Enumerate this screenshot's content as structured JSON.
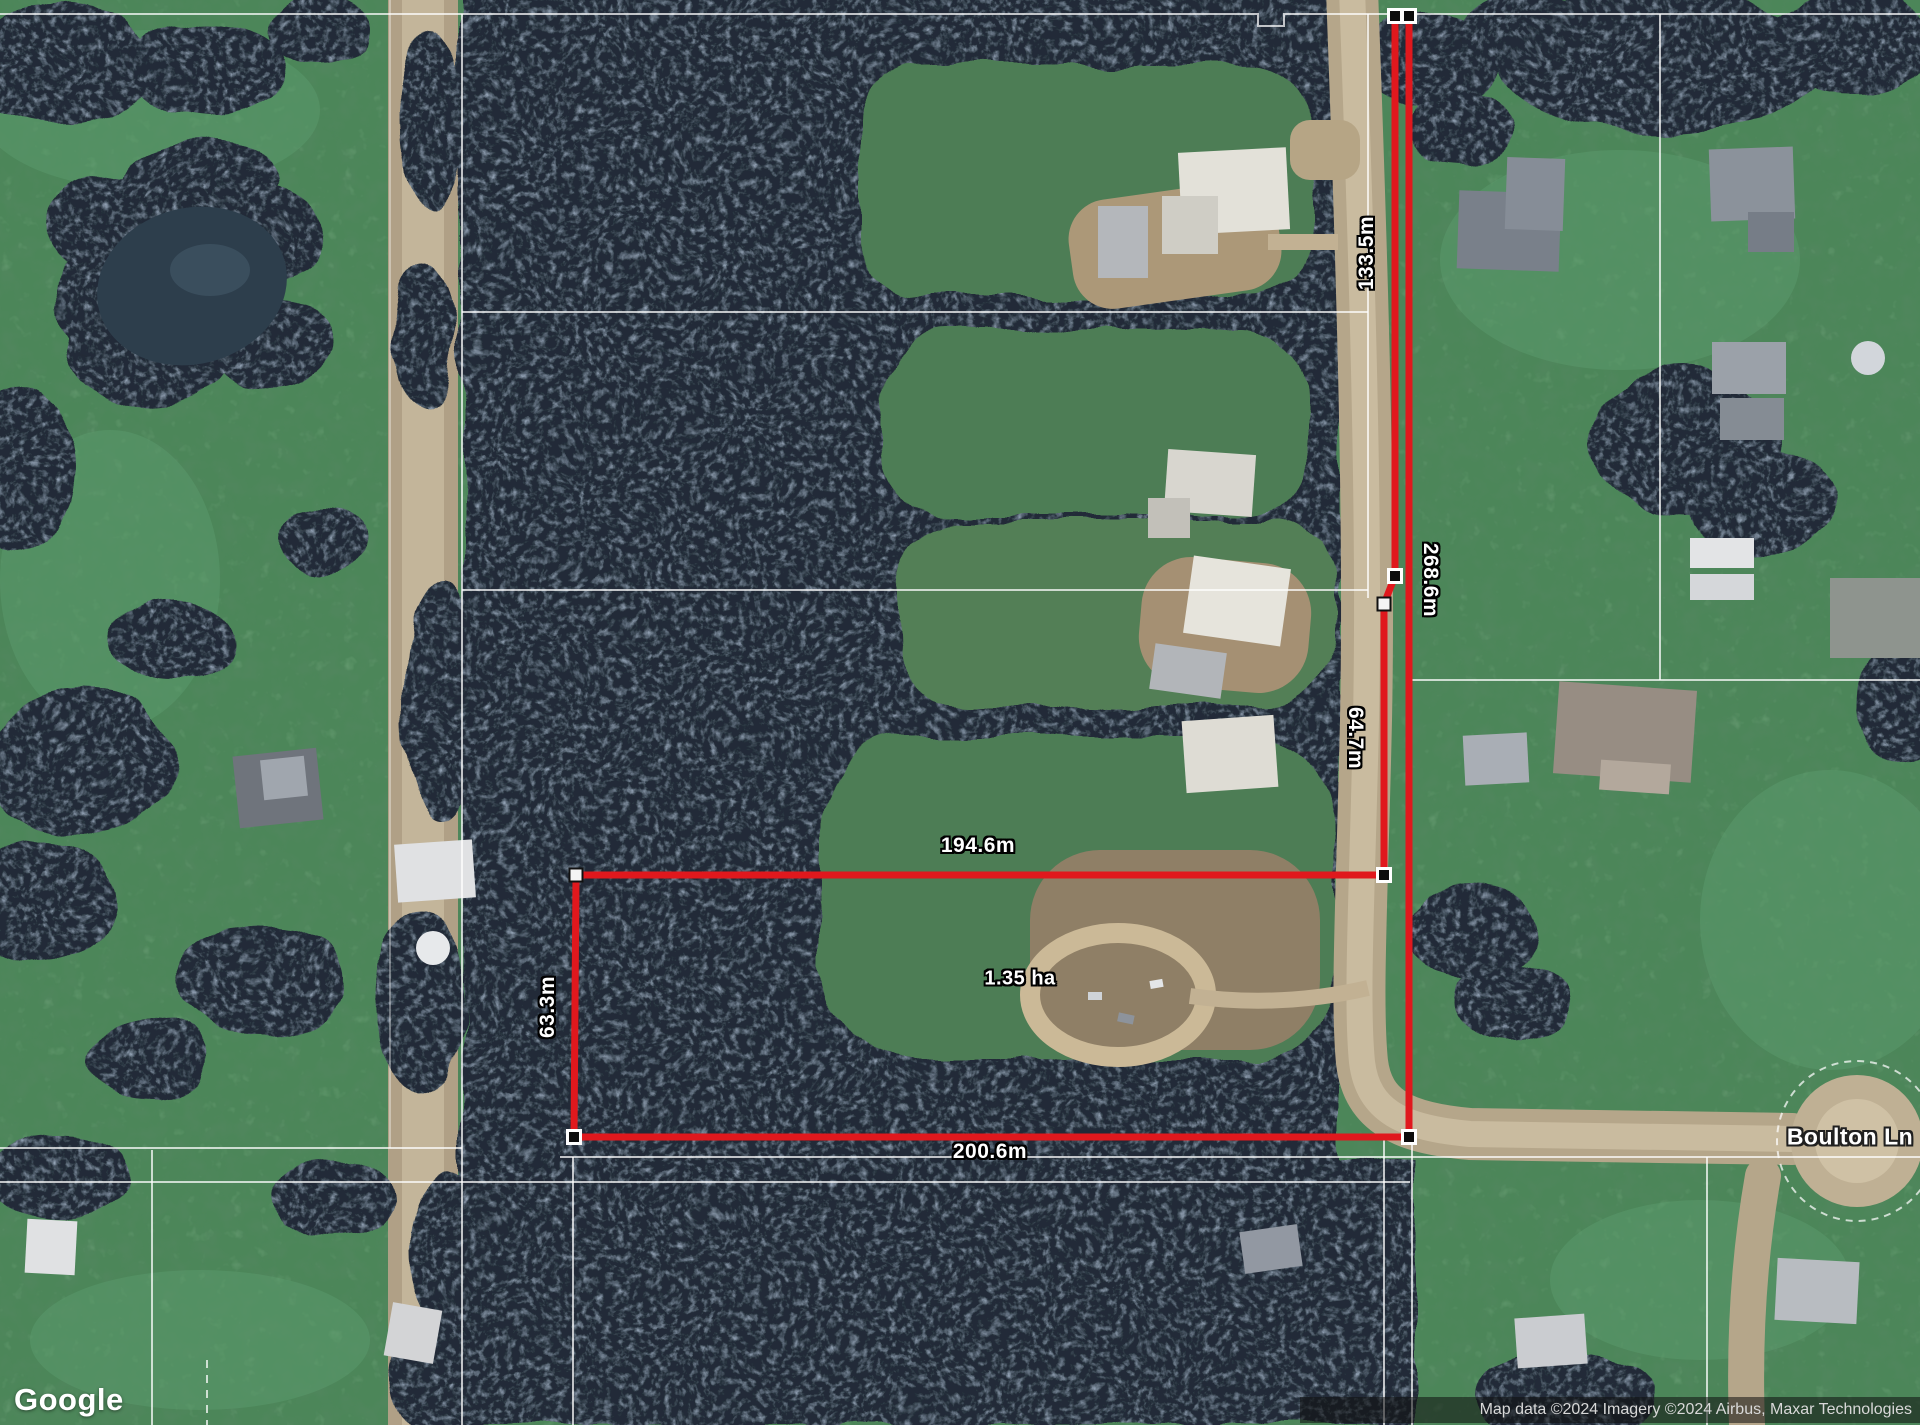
{
  "map_overlay": {
    "measurements": [
      {
        "id": "strip-upper-left-edge",
        "label": "133.5m"
      },
      {
        "id": "strip-right-edge-full",
        "label": "268.6m"
      },
      {
        "id": "strip-lower-left-edge",
        "label": "64.7m"
      },
      {
        "id": "block-top-width",
        "label": "194.6m"
      },
      {
        "id": "block-left-depth",
        "label": "63.3m"
      },
      {
        "id": "block-bottom-width",
        "label": "200.6m"
      }
    ],
    "area_label": "1.35 ha",
    "colors": {
      "measurement_line": "#e0181d",
      "label_text": "#ffffff",
      "label_outline": "#000000"
    }
  },
  "road_labels": [
    {
      "name": "Boulton Ln"
    }
  ],
  "branding": {
    "logo_text": "Google"
  },
  "attribution": {
    "text": "Map data ©2024 Imagery ©2024 Airbus, Maxar Technologies"
  }
}
